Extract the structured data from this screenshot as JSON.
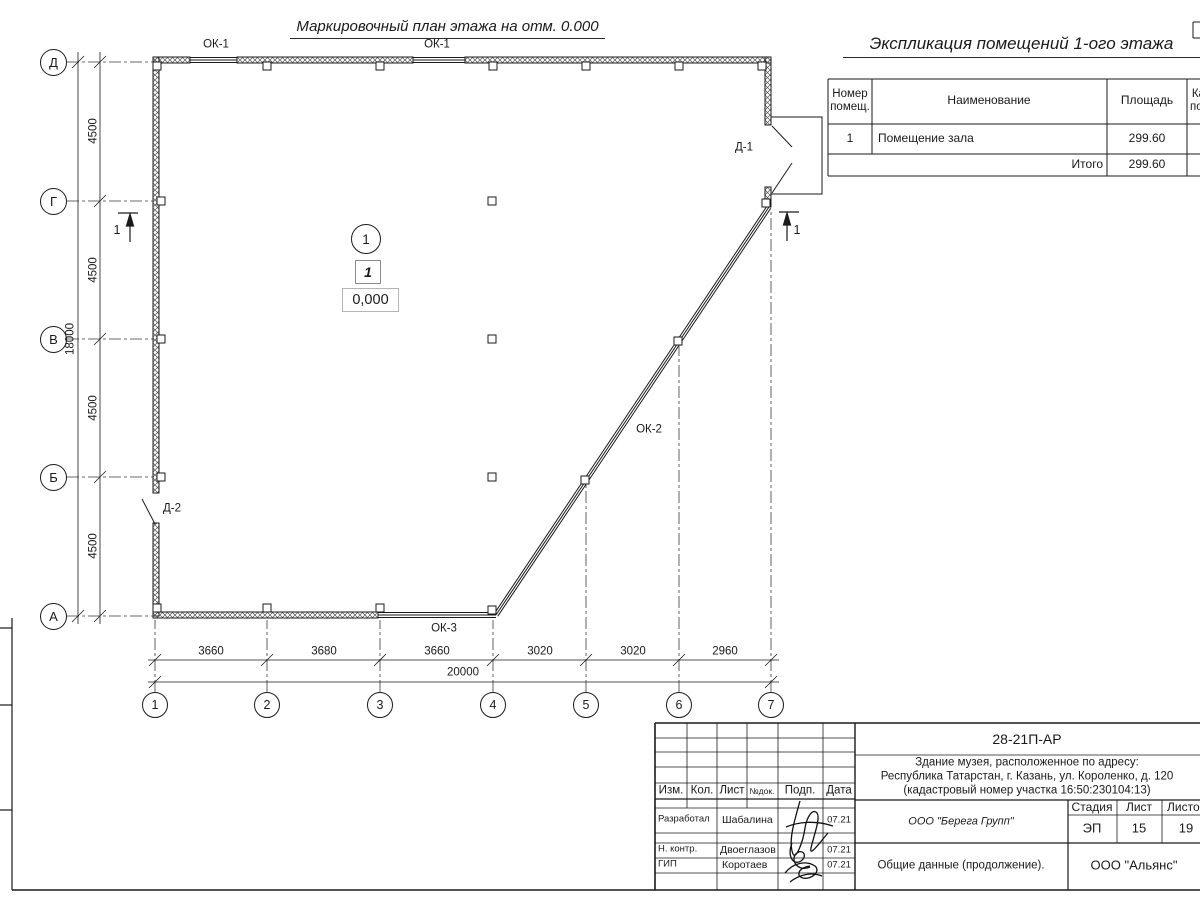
{
  "colors": {
    "ink": "#1a1a1a",
    "paper": "#ffffff",
    "hatch": "#555555"
  },
  "plan": {
    "title": "Маркировочный план этажа на отм. 0.000",
    "axis_rows": [
      "Д",
      "Г",
      "В",
      "Б",
      "А"
    ],
    "axis_cols": [
      "1",
      "2",
      "3",
      "4",
      "5",
      "6",
      "7"
    ],
    "dims_bottom": [
      "3660",
      "3680",
      "3660",
      "3020",
      "3020",
      "2960"
    ],
    "dim_bottom_total": "20000",
    "dims_left": [
      "4500",
      "4500",
      "4500",
      "4500"
    ],
    "dim_left_total": "18000",
    "labels": {
      "ok1": "ОК-1",
      "ok2": "ОК-2",
      "ok3": "ОК-3",
      "d1": "Д-1",
      "d2": "Д-2"
    },
    "room_marker": "1",
    "room_number": "1",
    "elevation": "0,000",
    "section_mark": "1"
  },
  "explication": {
    "title": "Экспликация помещений 1-ого этажа",
    "headers": {
      "number": "Номер\nпомещ.",
      "name": "Наименование",
      "area": "Площадь",
      "category": "Кат.\nпом."
    },
    "rows": [
      {
        "number": "1",
        "name": "Помещение зала",
        "area": "299.60"
      }
    ],
    "total_label": "Итого",
    "total_area": "299.60"
  },
  "titleblock": {
    "doc_number": "28-21П-АР",
    "address_line1": "Здание музея, расположенное по адресу:",
    "address_line2": "Республика Татарстан, г. Казань, ул. Короленко, д. 120",
    "address_line3": "(кадастровый номер участка 16:50:230104:13)",
    "cols": {
      "izm": "Изм.",
      "kol": "Кол.",
      "list": "Лист",
      "ndoc": "№док.",
      "podp": "Подп.",
      "data": "Дата"
    },
    "row_razrabotal": {
      "role": "Разработал",
      "name": "Шабалина",
      "date": "07.21"
    },
    "row_nkontr": {
      "role": "Н. контр.",
      "name": "Двоеглазов",
      "date": "07.21"
    },
    "row_gip": {
      "role": "ГИП",
      "name": "Коротаев",
      "date": "07.21"
    },
    "company": "ООО \"Берега Групп\"",
    "stage_col": "Стадия",
    "list_col": "Лист",
    "listov_col": "Листов",
    "stage": "ЭП",
    "sheet": "15",
    "sheets": "19",
    "doc_title": "Общие данные (продолжение).",
    "org": "ООО \"Альянс\""
  }
}
